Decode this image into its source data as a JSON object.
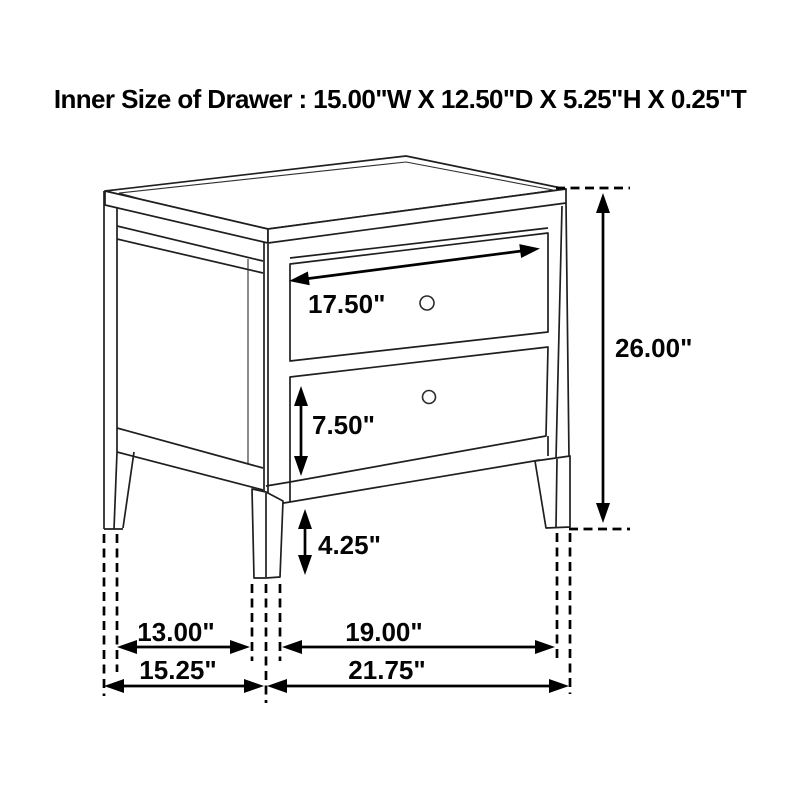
{
  "title": "Inner Size of Drawer : 15.00\"W X 12.50\"D X 5.25\"H X 0.25\"T",
  "drawing": {
    "subject": "two-drawer nightstand dimension diagram",
    "labels": {
      "drawer_width": "17.50\"",
      "bottom_drawer_height": "7.50\"",
      "leg_height": "4.25\"",
      "overall_height": "26.00\"",
      "side_leg_spacing": "13.00\"",
      "side_overall_depth": "15.25\"",
      "front_leg_spacing": "19.00\"",
      "front_overall_width": "21.75\""
    },
    "colors": {
      "background": "#ffffff",
      "outline": "#1f1f1f",
      "dimension": "#000000",
      "text": "#000000"
    }
  }
}
